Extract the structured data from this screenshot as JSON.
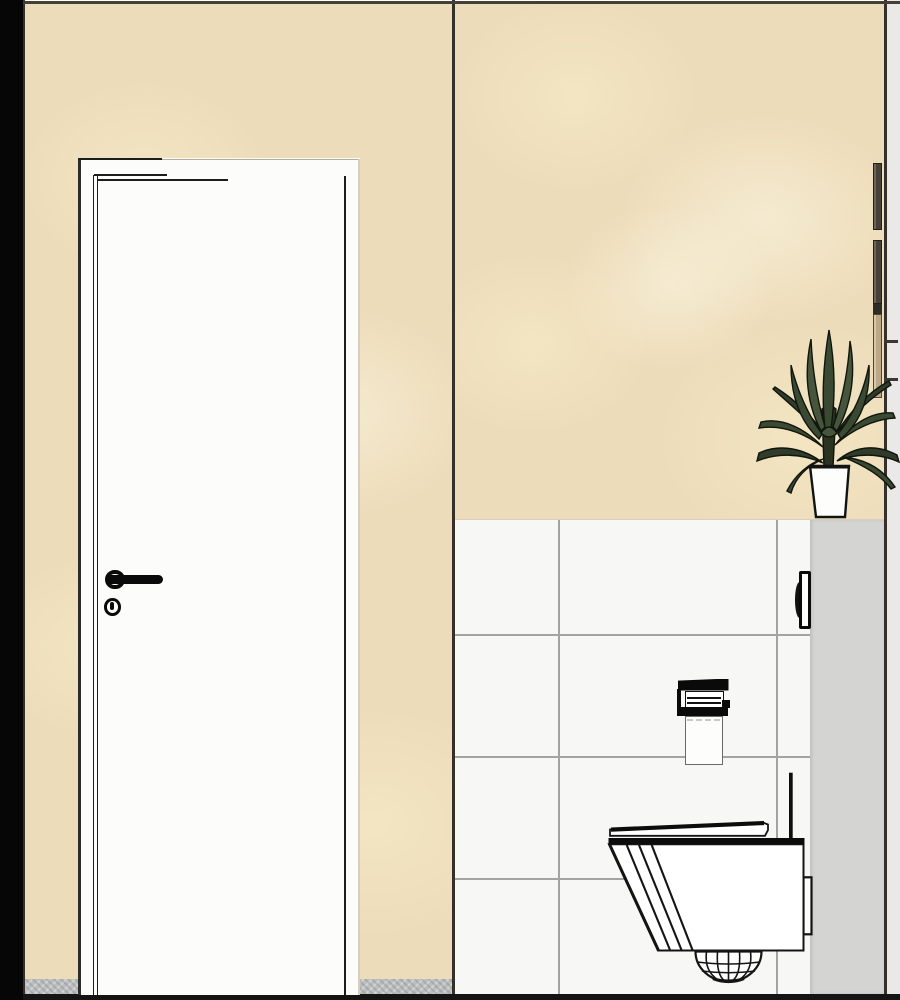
{
  "scene": {
    "kind": "3d-interior-rendering",
    "room": "bathroom-wc-elevation"
  },
  "colors": {
    "black_strip": "#060606",
    "edge_dark": "#35312a",
    "wall_beige": "#eddcba",
    "wall_beige_shade": "#ddc89f",
    "wall_beige_light": "#f6edd8",
    "door_white": "#fcfcfb",
    "line_dark": "#1d1d1b",
    "door_frame_soft": "#d6cfbf",
    "tile_white": "#f7f7f5",
    "grout_grey": "#a3a3a1",
    "tile_edge": "#d8d0be",
    "recess_grey": "#d4d4d2",
    "outer_strip_grey": "#eae9e7",
    "skirting_grey": "#bcbfbf",
    "floor_dark": "#141414",
    "hardware_black": "#0a0a0a",
    "fixture_white": "#fdfdfc",
    "wood_tan": "#bca887",
    "panel_dark": "#454139",
    "plant_green": "#3a4931",
    "plant_green_dark": "#2f3c29",
    "plant_green_light": "#46553b",
    "plant_outline": "#10150e",
    "trunk_brown": "#2a331f",
    "pot_white": "#fdfdfc"
  },
  "objects": {
    "left_wall": "beige wall left section",
    "right_wall": "beige wall right section",
    "tile_wall": "white tiled wall",
    "recess_wall": "grey recess side wall",
    "door": "white interior door",
    "door_handle": "black lever door handle",
    "keyhole": "keyhole escutcheon",
    "plant": "potted dracaena plant",
    "plant_pot": "white square planter",
    "wall_panel": "wall-mounted panel edge",
    "dispenser": "wall-mounted dispenser side view",
    "toilet_paper_holder": "toilet paper holder with roll",
    "toilet": "wall-hung toilet side view",
    "skirting": "grey skirting strip",
    "floor": "dark floor line"
  }
}
